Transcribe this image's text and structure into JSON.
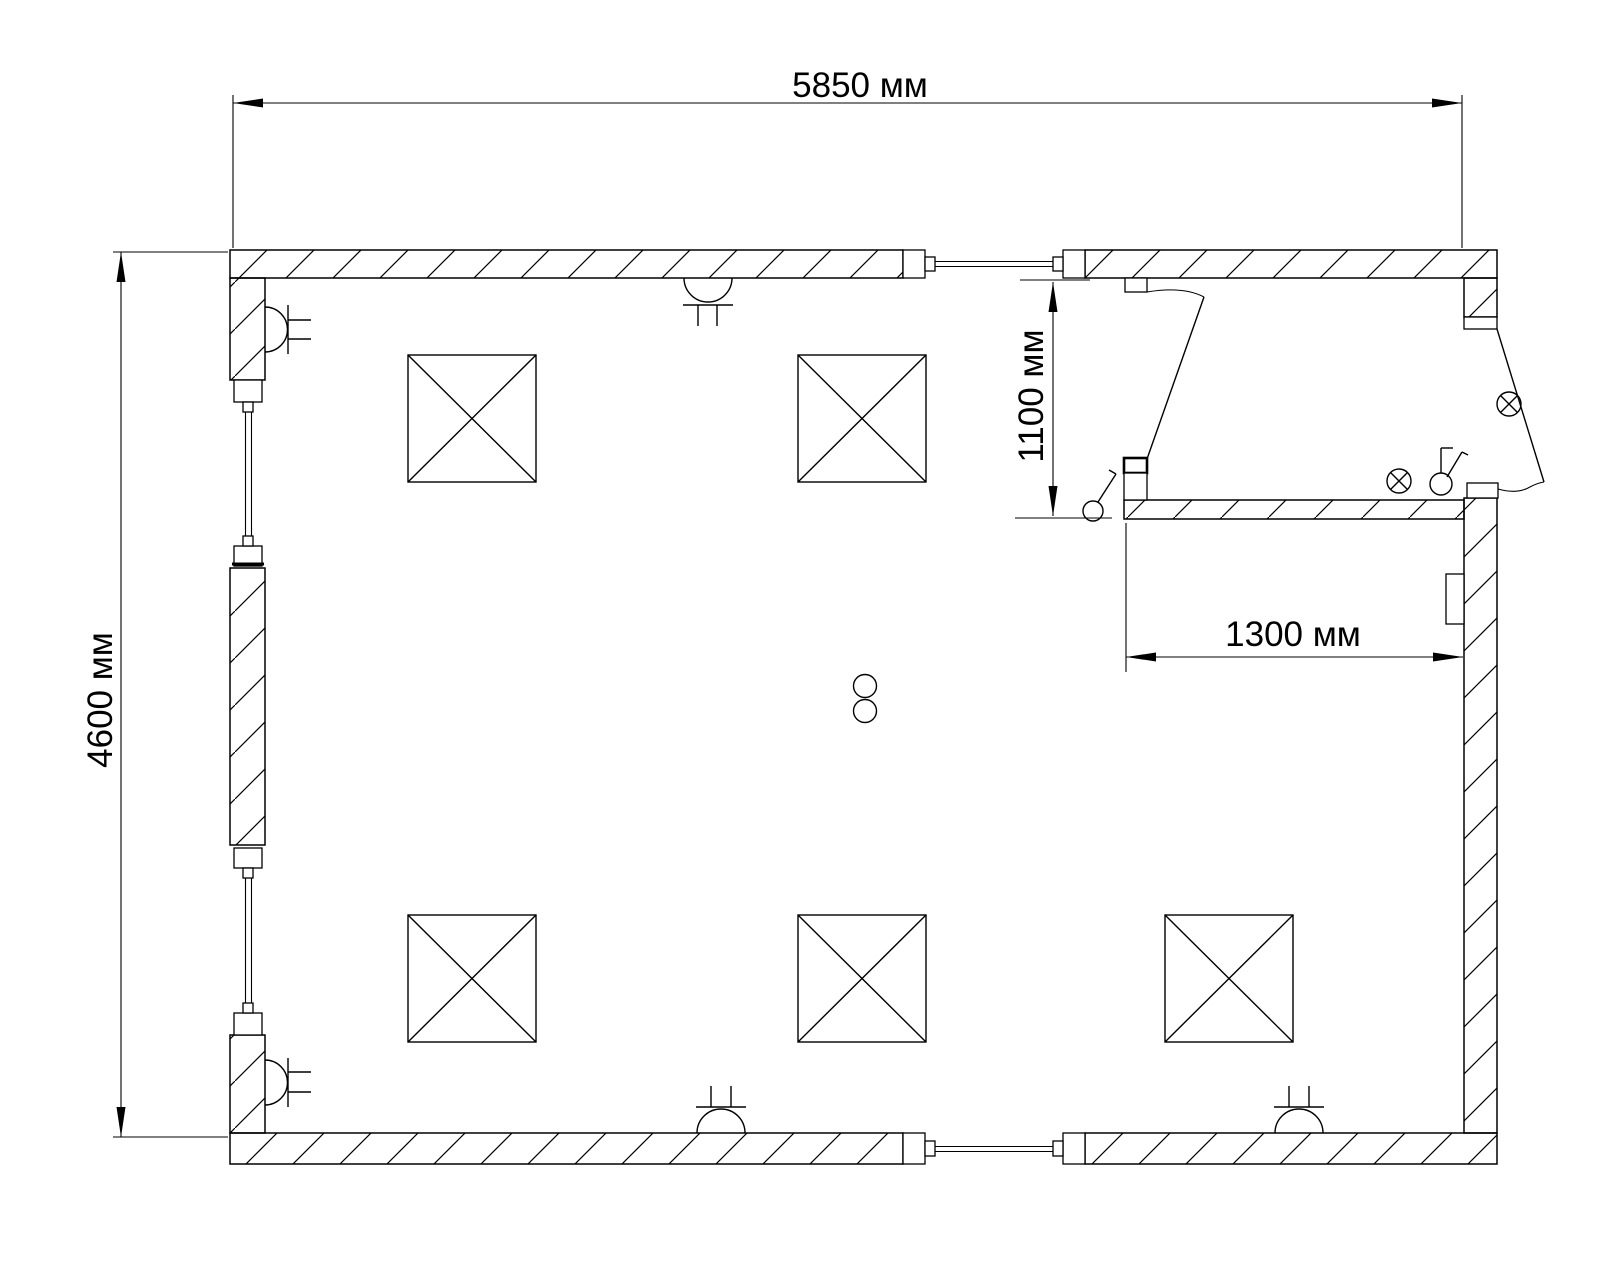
{
  "drawing": {
    "kind": "floor-plan",
    "background_color": "#ffffff",
    "line_color": "#000000",
    "dimensions": {
      "total_width": "5850 мм",
      "total_height": "4600 мм",
      "entry_depth": "1100 мм",
      "entry_width": "1300 мм"
    },
    "symbols": {
      "crossed_square": "ceiling-panel",
      "crossed_square_count": 5,
      "wall_semicircle": "wall-lamp",
      "wall_lamp_count": 5,
      "circle_with_cross": "lamp",
      "circle_with_cross_count": 2,
      "circle_with_stroke": "switch",
      "switch_count": 2,
      "double_circle": "pendant-point",
      "double_circle_count": 1,
      "window_count": 4,
      "door_count": 2
    }
  }
}
